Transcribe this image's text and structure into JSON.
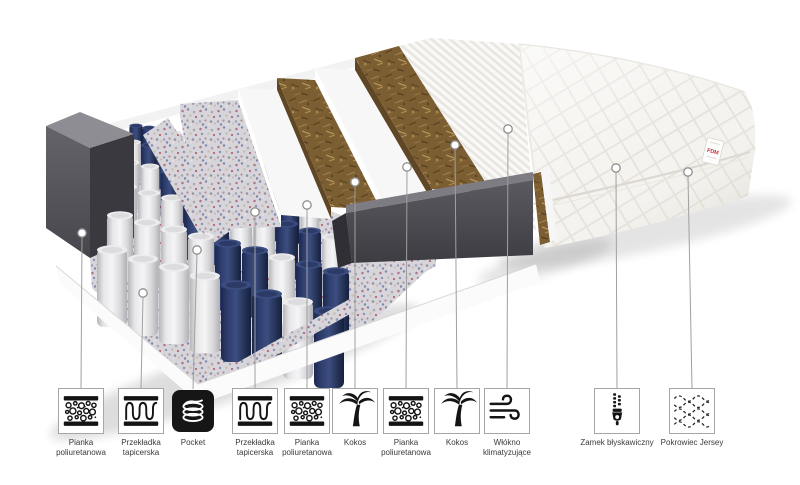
{
  "brand_tag": "FDM",
  "legend": {
    "items": [
      {
        "label": "Pianka poliuretanowa",
        "icon": "foam-icon"
      },
      {
        "label": "Przekładka tapicerska",
        "icon": "serpentine-icon"
      },
      {
        "label": "Pocket",
        "icon": "pocket-spring-icon"
      },
      {
        "label": "Przekładka tapicerska",
        "icon": "serpentine-icon"
      },
      {
        "label": "Pianka poliuretanowa",
        "icon": "foam-icon"
      },
      {
        "label": "Kokos",
        "icon": "palm-icon"
      },
      {
        "label": "Pianka poliuretanowa",
        "icon": "foam-icon"
      },
      {
        "label": "Kokos",
        "icon": "palm-icon"
      },
      {
        "label": "Włókno klimatyzujące",
        "icon": "wind-icon"
      },
      {
        "label": "Zamek błyskawiczny",
        "icon": "zipper-icon"
      },
      {
        "label": "Pokrowiec Jersey",
        "icon": "jersey-fabric-icon"
      }
    ]
  },
  "colors": {
    "navy_spring": "#2c3a66",
    "coco_brown": "#7c5e33",
    "foam_white": "#f7f7f8",
    "frame_gray": "#4b4b4f",
    "speckle_base": "#d7d5d9",
    "cover_white": "#f5f3ef",
    "tag_red": "#c03540"
  }
}
